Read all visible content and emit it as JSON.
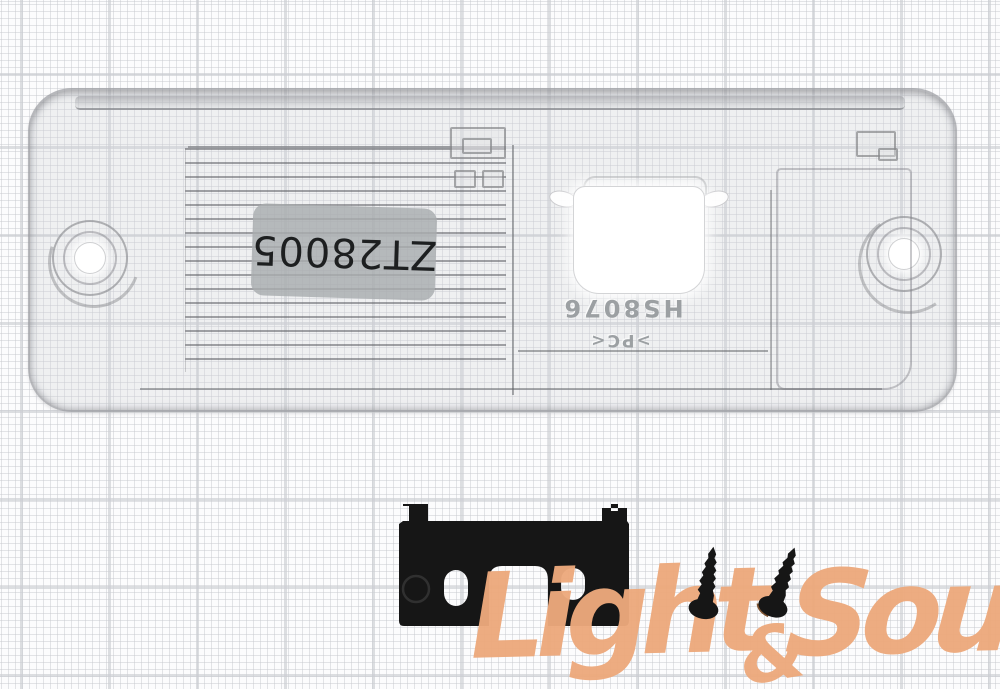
{
  "photo": {
    "subject": "transparent license plate lamp camera-mount housing with metal bracket and two screws on graph paper",
    "sticker_label": {
      "text": "ZT28005"
    },
    "embossed": {
      "code": "HS8076",
      "material_mark": ">PC<"
    },
    "watermark": {
      "word1": "Light",
      "ampersand": "&",
      "word2": "Sound"
    }
  },
  "colors": {
    "accent-orange": "#eda97c",
    "bracket-black": "#161616",
    "screw-head-brown": "#7d5331",
    "label-gray": "#aaaeaf",
    "grid-fine": "#c4c6cb",
    "grid-major": "#cbcdd2"
  }
}
